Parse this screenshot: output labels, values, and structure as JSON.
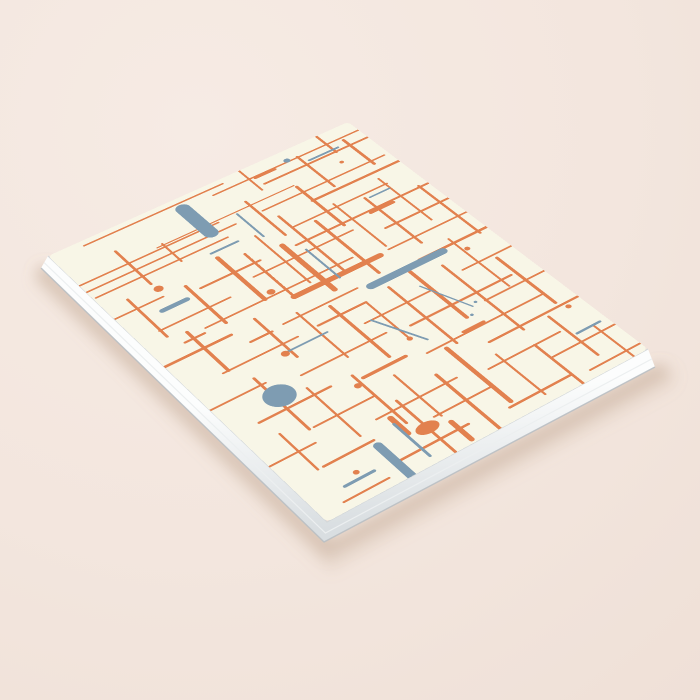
{
  "scene": {
    "canvas": {
      "width": 700,
      "height": 700
    },
    "description": "Blank softcover notebook mockup, angled flat-lay on a pale pink surface; cover shows abstract mid-century pattern of crossing orange and slate-blue lines, pills and dots on cream",
    "background": {
      "base": "#f3e6de",
      "light": "#f6ebe4",
      "dark": "#efe0d7"
    }
  },
  "notebook": {
    "cover_color": "#f8f6e7",
    "design_size": [
      600,
      800
    ],
    "corners": {
      "left": [
        48,
        256
      ],
      "top": [
        348,
        122
      ],
      "right": [
        648,
        349
      ],
      "bottom": [
        327,
        522
      ]
    },
    "page_edge": {
      "face_top": "#fcfdfd",
      "face_bottom": "#d9dee1",
      "cover_seam": "#d2d6d8",
      "striation": "#eceff0",
      "lip": "#b9bfc3",
      "offsets": {
        "left": [
          -7,
          12
        ],
        "bottom": [
          -3,
          20
        ],
        "right": [
          7,
          18
        ]
      }
    },
    "shadow": {
      "color": "#b99a87",
      "opacity": 0.38,
      "blur": 7
    }
  },
  "pattern": {
    "background": "#f8f6e7",
    "colors": {
      "o": "#e2814f",
      "b": "#7e9cb2"
    },
    "elements": [
      {
        "t": "h",
        "s": "o",
        "x1": 60,
        "y": 14,
        "x2": 330,
        "w": 4
      },
      {
        "t": "h",
        "s": "o",
        "x1": 300,
        "y": 32,
        "x2": 620,
        "w": 4
      },
      {
        "t": "h",
        "s": "o",
        "x1": 385,
        "y": 60,
        "x2": 615,
        "w": 5
      },
      {
        "t": "h",
        "s": "o",
        "x1": 150,
        "y": 96,
        "x2": 420,
        "w": 3
      },
      {
        "t": "h",
        "s": "o",
        "x1": -15,
        "y": 102,
        "x2": 265,
        "w": 4
      },
      {
        "t": "h",
        "s": "o",
        "x1": -15,
        "y": 124,
        "x2": 285,
        "w": 4
      },
      {
        "t": "h",
        "s": "o",
        "x1": 5,
        "y": 146,
        "x2": 255,
        "w": 4
      },
      {
        "t": "h",
        "s": "o",
        "x1": 340,
        "y": 122,
        "x2": 590,
        "w": 4
      },
      {
        "t": "h",
        "s": "o",
        "x1": 420,
        "y": 152,
        "x2": 625,
        "w": 6
      },
      {
        "t": "h",
        "s": "o",
        "x1": 355,
        "y": 192,
        "x2": 545,
        "w": 4
      },
      {
        "t": "h",
        "s": "o",
        "x1": -20,
        "y": 212,
        "x2": 90,
        "w": 4
      },
      {
        "t": "h",
        "s": "o",
        "x1": 148,
        "y": 232,
        "x2": 262,
        "w": 5
      },
      {
        "t": "h",
        "s": "o",
        "x1": 330,
        "y": 236,
        "x2": 620,
        "w": 5
      },
      {
        "t": "h",
        "s": "o",
        "x1": 40,
        "y": 282,
        "x2": 172,
        "w": 4
      },
      {
        "t": "h",
        "s": "o",
        "x1": 230,
        "y": 262,
        "x2": 425,
        "w": 4
      },
      {
        "t": "h",
        "s": "o",
        "x1": 470,
        "y": 292,
        "x2": 622,
        "w": 5
      },
      {
        "t": "h",
        "s": "o",
        "x1": 100,
        "y": 322,
        "x2": 382,
        "w": 4
      },
      {
        "t": "h",
        "s": "o",
        "x1": 252,
        "y": 346,
        "x2": 420,
        "w": 12
      },
      {
        "t": "h",
        "s": "o",
        "x1": 440,
        "y": 342,
        "x2": 630,
        "w": 4
      },
      {
        "t": "h",
        "s": "o",
        "x1": -20,
        "y": 362,
        "x2": 122,
        "w": 6
      },
      {
        "t": "h",
        "s": "o",
        "x1": 200,
        "y": 392,
        "x2": 342,
        "w": 4
      },
      {
        "t": "h",
        "s": "o",
        "x1": 462,
        "y": 396,
        "x2": 622,
        "w": 6
      },
      {
        "t": "h",
        "s": "o",
        "x1": 62,
        "y": 432,
        "x2": 200,
        "w": 4
      },
      {
        "t": "h",
        "s": "o",
        "x1": 240,
        "y": 430,
        "x2": 332,
        "w": 5
      },
      {
        "t": "h",
        "s": "o",
        "x1": 300,
        "y": 472,
        "x2": 432,
        "w": 4
      },
      {
        "t": "h",
        "s": "o",
        "x1": 500,
        "y": 462,
        "x2": 626,
        "w": 4
      },
      {
        "t": "h",
        "s": "o",
        "x1": -15,
        "y": 492,
        "x2": 100,
        "w": 4
      },
      {
        "t": "h",
        "s": "o",
        "x1": 152,
        "y": 512,
        "x2": 312,
        "w": 4
      },
      {
        "t": "h",
        "s": "o",
        "x1": 352,
        "y": 522,
        "x2": 552,
        "w": 5
      },
      {
        "t": "h",
        "s": "o",
        "x1": 480,
        "y": 547,
        "x2": 632,
        "w": 4
      },
      {
        "t": "h",
        "s": "o",
        "x1": 42,
        "y": 562,
        "x2": 172,
        "w": 5
      },
      {
        "t": "h",
        "s": "o",
        "x1": 222,
        "y": 577,
        "x2": 302,
        "w": 7
      },
      {
        "t": "h",
        "s": "o",
        "x1": 332,
        "y": 592,
        "x2": 562,
        "w": 4
      },
      {
        "t": "h",
        "s": "o",
        "x1": 100,
        "y": 622,
        "x2": 212,
        "w": 4
      },
      {
        "t": "h",
        "s": "o",
        "x1": 422,
        "y": 632,
        "x2": 622,
        "w": 5
      },
      {
        "t": "h",
        "s": "o",
        "x1": -15,
        "y": 652,
        "x2": 82,
        "w": 4
      },
      {
        "t": "h",
        "s": "o",
        "x1": 182,
        "y": 667,
        "x2": 332,
        "w": 4
      },
      {
        "t": "h",
        "s": "o",
        "x1": 382,
        "y": 682,
        "x2": 522,
        "w": 4
      },
      {
        "t": "h",
        "s": "o",
        "x1": 62,
        "y": 702,
        "x2": 152,
        "w": 5
      },
      {
        "t": "h",
        "s": "o",
        "x1": 252,
        "y": 717,
        "x2": 362,
        "w": 4
      },
      {
        "t": "h",
        "s": "o",
        "x1": 472,
        "y": 722,
        "x2": 632,
        "w": 4
      },
      {
        "t": "h",
        "s": "o",
        "x1": 152,
        "y": 762,
        "x2": 282,
        "w": 5
      },
      {
        "t": "h",
        "s": "o",
        "x1": 352,
        "y": 772,
        "x2": 472,
        "w": 5
      },
      {
        "t": "h",
        "s": "o",
        "x1": 42,
        "y": 782,
        "x2": 122,
        "w": 4
      },
      {
        "t": "h",
        "s": "o",
        "x1": 500,
        "y": 782,
        "x2": 622,
        "w": 4
      },
      {
        "t": "v",
        "s": "o",
        "x": 532,
        "y1": -20,
        "y2": 62,
        "w": 5
      },
      {
        "t": "v",
        "s": "o",
        "x": 372,
        "y1": -15,
        "y2": 72,
        "w": 4
      },
      {
        "t": "v",
        "s": "o",
        "x": 472,
        "y1": 30,
        "y2": 142,
        "w": 5
      },
      {
        "t": "v",
        "s": "o",
        "x": 562,
        "y1": 40,
        "y2": 132,
        "w": 6
      },
      {
        "t": "v",
        "s": "o",
        "x": 92,
        "y1": 60,
        "y2": 172,
        "w": 5
      },
      {
        "t": "v",
        "s": "o",
        "x": 162,
        "y1": 92,
        "y2": 152,
        "w": 4
      },
      {
        "t": "v",
        "s": "o",
        "x": 332,
        "y1": 82,
        "y2": 202,
        "w": 5
      },
      {
        "t": "v",
        "s": "o",
        "x": 422,
        "y1": 102,
        "y2": 242,
        "w": 6
      },
      {
        "t": "v",
        "s": "o",
        "x": 42,
        "y1": 182,
        "y2": 302,
        "w": 5
      },
      {
        "t": "v",
        "s": "o",
        "x": 132,
        "y1": 212,
        "y2": 332,
        "w": 6
      },
      {
        "t": "v",
        "s": "o",
        "x": 212,
        "y1": 182,
        "y2": 322,
        "w": 8
      },
      {
        "t": "v",
        "s": "o",
        "x": 252,
        "y1": 202,
        "y2": 342,
        "w": 5
      },
      {
        "t": "v",
        "s": "o",
        "x": 292,
        "y1": 172,
        "y2": 332,
        "w": 4
      },
      {
        "t": "v",
        "s": "o",
        "x": 312,
        "y1": 222,
        "y2": 372,
        "w": 10
      },
      {
        "t": "v",
        "s": "o",
        "x": 352,
        "y1": 152,
        "y2": 342,
        "w": 5
      },
      {
        "t": "v",
        "s": "o",
        "x": 392,
        "y1": 202,
        "y2": 382,
        "w": 6
      },
      {
        "t": "v",
        "s": "o",
        "x": 442,
        "y1": 182,
        "y2": 332,
        "w": 4
      },
      {
        "t": "v",
        "s": "o",
        "x": 492,
        "y1": 202,
        "y2": 362,
        "w": 5
      },
      {
        "t": "v",
        "s": "o",
        "x": 542,
        "y1": 172,
        "y2": 322,
        "w": 4
      },
      {
        "t": "v",
        "s": "o",
        "x": 582,
        "y1": 232,
        "y2": 402,
        "w": 5
      },
      {
        "t": "v",
        "s": "o",
        "x": 72,
        "y1": 312,
        "y2": 432,
        "w": 6
      },
      {
        "t": "v",
        "s": "o",
        "x": 172,
        "y1": 352,
        "y2": 472,
        "w": 5
      },
      {
        "t": "v",
        "s": "o",
        "x": 232,
        "y1": 382,
        "y2": 522,
        "w": 4
      },
      {
        "t": "v",
        "s": "o",
        "x": 282,
        "y1": 402,
        "y2": 562,
        "w": 6
      },
      {
        "t": "v",
        "s": "o",
        "x": 332,
        "y1": 432,
        "y2": 542,
        "w": 4
      },
      {
        "t": "v",
        "s": "o",
        "x": 382,
        "y1": 422,
        "y2": 602,
        "w": 5
      },
      {
        "t": "v",
        "s": "o",
        "x": 432,
        "y1": 402,
        "y2": 562,
        "w": 7
      },
      {
        "t": "v",
        "s": "o",
        "x": 482,
        "y1": 432,
        "y2": 642,
        "w": 5
      },
      {
        "t": "v",
        "s": "o",
        "x": 532,
        "y1": 382,
        "y2": 542,
        "w": 4
      },
      {
        "t": "v",
        "s": "o",
        "x": 92,
        "y1": 472,
        "y2": 622,
        "w": 5
      },
      {
        "t": "v",
        "s": "o",
        "x": 142,
        "y1": 542,
        "y2": 682,
        "w": 4
      },
      {
        "t": "v",
        "s": "o",
        "x": 562,
        "y1": 472,
        "y2": 622,
        "w": 6
      },
      {
        "t": "v",
        "s": "o",
        "x": 212,
        "y1": 562,
        "y2": 702,
        "w": 5
      },
      {
        "t": "v",
        "s": "o",
        "x": 262,
        "y1": 602,
        "y2": 722,
        "w": 4
      },
      {
        "t": "v",
        "s": "o",
        "x": 312,
        "y1": 642,
        "y2": 812,
        "w": 6
      },
      {
        "t": "v",
        "s": "o",
        "x": 362,
        "y1": 602,
        "y2": 762,
        "w": 8
      },
      {
        "t": "v",
        "s": "o",
        "x": 412,
        "y1": 662,
        "y2": 782,
        "w": 4
      },
      {
        "t": "v",
        "s": "o",
        "x": 472,
        "y1": 682,
        "y2": 822,
        "w": 5
      },
      {
        "t": "v",
        "s": "o",
        "x": 532,
        "y1": 642,
        "y2": 762,
        "w": 5
      },
      {
        "t": "v",
        "s": "o",
        "x": 52,
        "y1": 602,
        "y2": 702,
        "w": 4
      },
      {
        "t": "v",
        "s": "o",
        "x": 230,
        "y1": 652,
        "y2": 812,
        "w": 5
      },
      {
        "t": "v",
        "s": "o",
        "x": 572,
        "y1": 702,
        "y2": 812,
        "w": 4
      },
      {
        "t": "v",
        "s": "o",
        "x": 200,
        "y1": 678,
        "y2": 722,
        "w": 10
      },
      {
        "t": "v",
        "s": "o",
        "x": 265,
        "y1": 742,
        "y2": 792,
        "w": 9
      },
      {
        "t": "v",
        "s": "b",
        "x": 240,
        "y1": 32,
        "y2": 118,
        "w": 26
      },
      {
        "t": "h",
        "s": "b",
        "x1": 362,
        "y": 402,
        "x2": 505,
        "w": 16
      },
      {
        "t": "c",
        "s": "b",
        "x": 100,
        "y": 530,
        "r": 26
      },
      {
        "t": "c",
        "s": "b",
        "x": 452,
        "y": 28,
        "r": 6
      },
      {
        "t": "h",
        "s": "b",
        "x1": 482,
        "y": 52,
        "x2": 542,
        "w": 5
      },
      {
        "t": "h",
        "s": "b",
        "x1": 210,
        "y": 166,
        "x2": 262,
        "w": 5
      },
      {
        "t": "h",
        "s": "b",
        "x1": 70,
        "y": 242,
        "x2": 116,
        "w": 10
      },
      {
        "t": "v",
        "s": "b",
        "x": 302,
        "y1": 102,
        "y2": 182,
        "w": 4
      },
      {
        "t": "v",
        "s": "b",
        "x": 336,
        "y1": 256,
        "y2": 352,
        "w": 4
      },
      {
        "t": "h",
        "s": "b",
        "x1": 166,
        "y": 452,
        "x2": 242,
        "w": 4
      },
      {
        "t": "l",
        "s": "b",
        "x1": 312,
        "y1": 472,
        "x2": 352,
        "y2": 566,
        "w": 4
      },
      {
        "t": "l",
        "s": "b",
        "x1": 422,
        "y1": 452,
        "x2": 456,
        "y2": 546,
        "w": 3
      },
      {
        "t": "v",
        "s": "b",
        "x": 150,
        "y1": 716,
        "y2": 812,
        "w": 15
      },
      {
        "t": "v",
        "s": "b",
        "x": 196,
        "y1": 692,
        "y2": 782,
        "w": 5
      },
      {
        "t": "h",
        "s": "b",
        "x1": 62,
        "y": 756,
        "x2": 114,
        "w": 6
      },
      {
        "t": "h",
        "s": "b",
        "x1": 540,
        "y": 702,
        "x2": 586,
        "w": 5
      },
      {
        "t": "c",
        "s": "b",
        "x": 442,
        "y": 562,
        "r": 3
      },
      {
        "t": "c",
        "s": "b",
        "x": 466,
        "y": 540,
        "r": 3
      },
      {
        "t": "h",
        "s": "b",
        "x1": 500,
        "y": 206,
        "x2": 540,
        "w": 4
      },
      {
        "t": "c",
        "s": "o",
        "x": 95,
        "y": 190,
        "r": 8
      },
      {
        "t": "c",
        "s": "o",
        "x": 230,
        "y": 312,
        "r": 7
      },
      {
        "t": "c",
        "s": "o",
        "x": 162,
        "y": 454,
        "r": 7
      },
      {
        "t": "c",
        "s": "o",
        "x": 332,
        "y": 547,
        "r": 5
      },
      {
        "t": "c",
        "s": "o",
        "x": 205,
        "y": 587,
        "r": 6
      },
      {
        "t": "c",
        "s": "o",
        "x": 540,
        "y": 422,
        "r": 5
      },
      {
        "t": "c",
        "s": "o",
        "x": 572,
        "y": 642,
        "r": 5
      },
      {
        "t": "c",
        "s": "o",
        "x": 92,
        "y": 742,
        "r": 5
      },
      {
        "t": "e",
        "s": "o",
        "x": 230,
        "y": 730,
        "rx": 20,
        "ry": 13
      },
      {
        "t": "c",
        "s": "o",
        "x": 522,
        "y": 92,
        "r": 4
      },
      {
        "t": "h",
        "s": "o",
        "x1": 382,
        "y": 36,
        "x2": 422,
        "w": 6
      },
      {
        "t": "h",
        "s": "o",
        "x1": 56,
        "y": 332,
        "x2": 92,
        "w": 5
      },
      {
        "t": "h",
        "s": "o",
        "x1": 476,
        "y": 242,
        "x2": 522,
        "w": 7
      },
      {
        "t": "h",
        "s": "o",
        "x1": 136,
        "y": 396,
        "x2": 176,
        "w": 5
      },
      {
        "t": "h",
        "s": "o",
        "x1": 406,
        "y": 587,
        "x2": 446,
        "w": 6
      }
    ]
  }
}
